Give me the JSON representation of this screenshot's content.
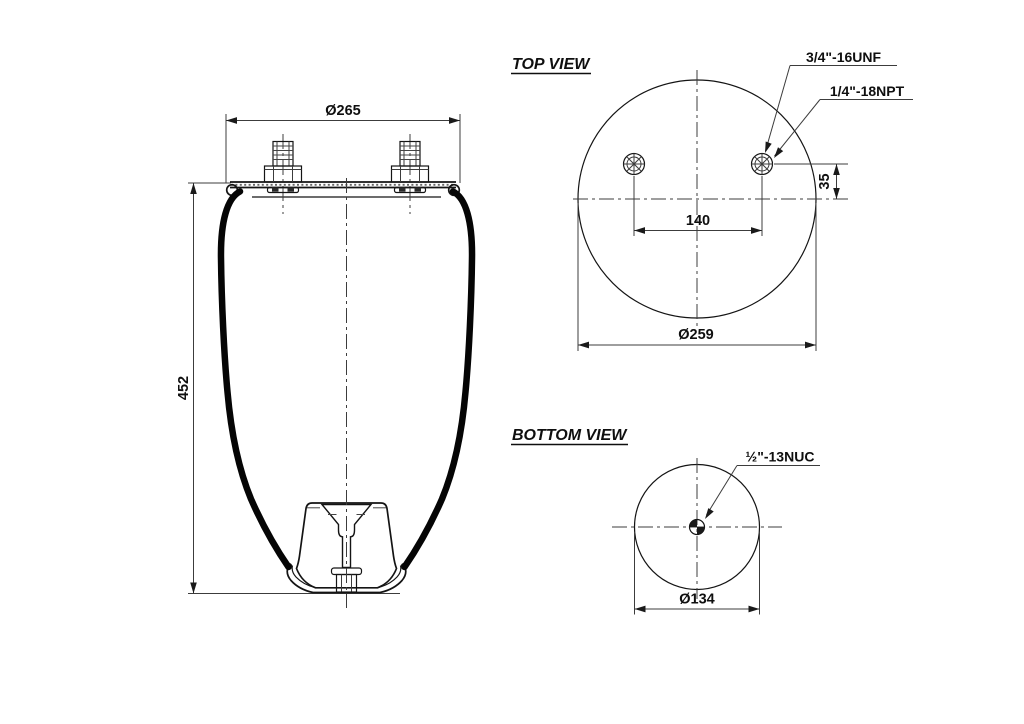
{
  "style": {
    "background": "#ffffff",
    "ink": "#1a1a1a"
  },
  "side_view": {
    "dim_top_plate_diameter": "Ø265",
    "dim_overall_height": "452"
  },
  "top_view": {
    "title": "TOP VIEW",
    "stud_thread_label": "3/4\"-16UNF",
    "air_port_thread_label": "1/4\"-18NPT",
    "dim_stud_spacing": "140",
    "dim_port_offset": "35",
    "dim_plate_diameter": "Ø259"
  },
  "bottom_view": {
    "title": "BOTTOM VIEW",
    "stud_thread_label": "½\"-13NUC",
    "dim_piston_diameter": "Ø134"
  }
}
